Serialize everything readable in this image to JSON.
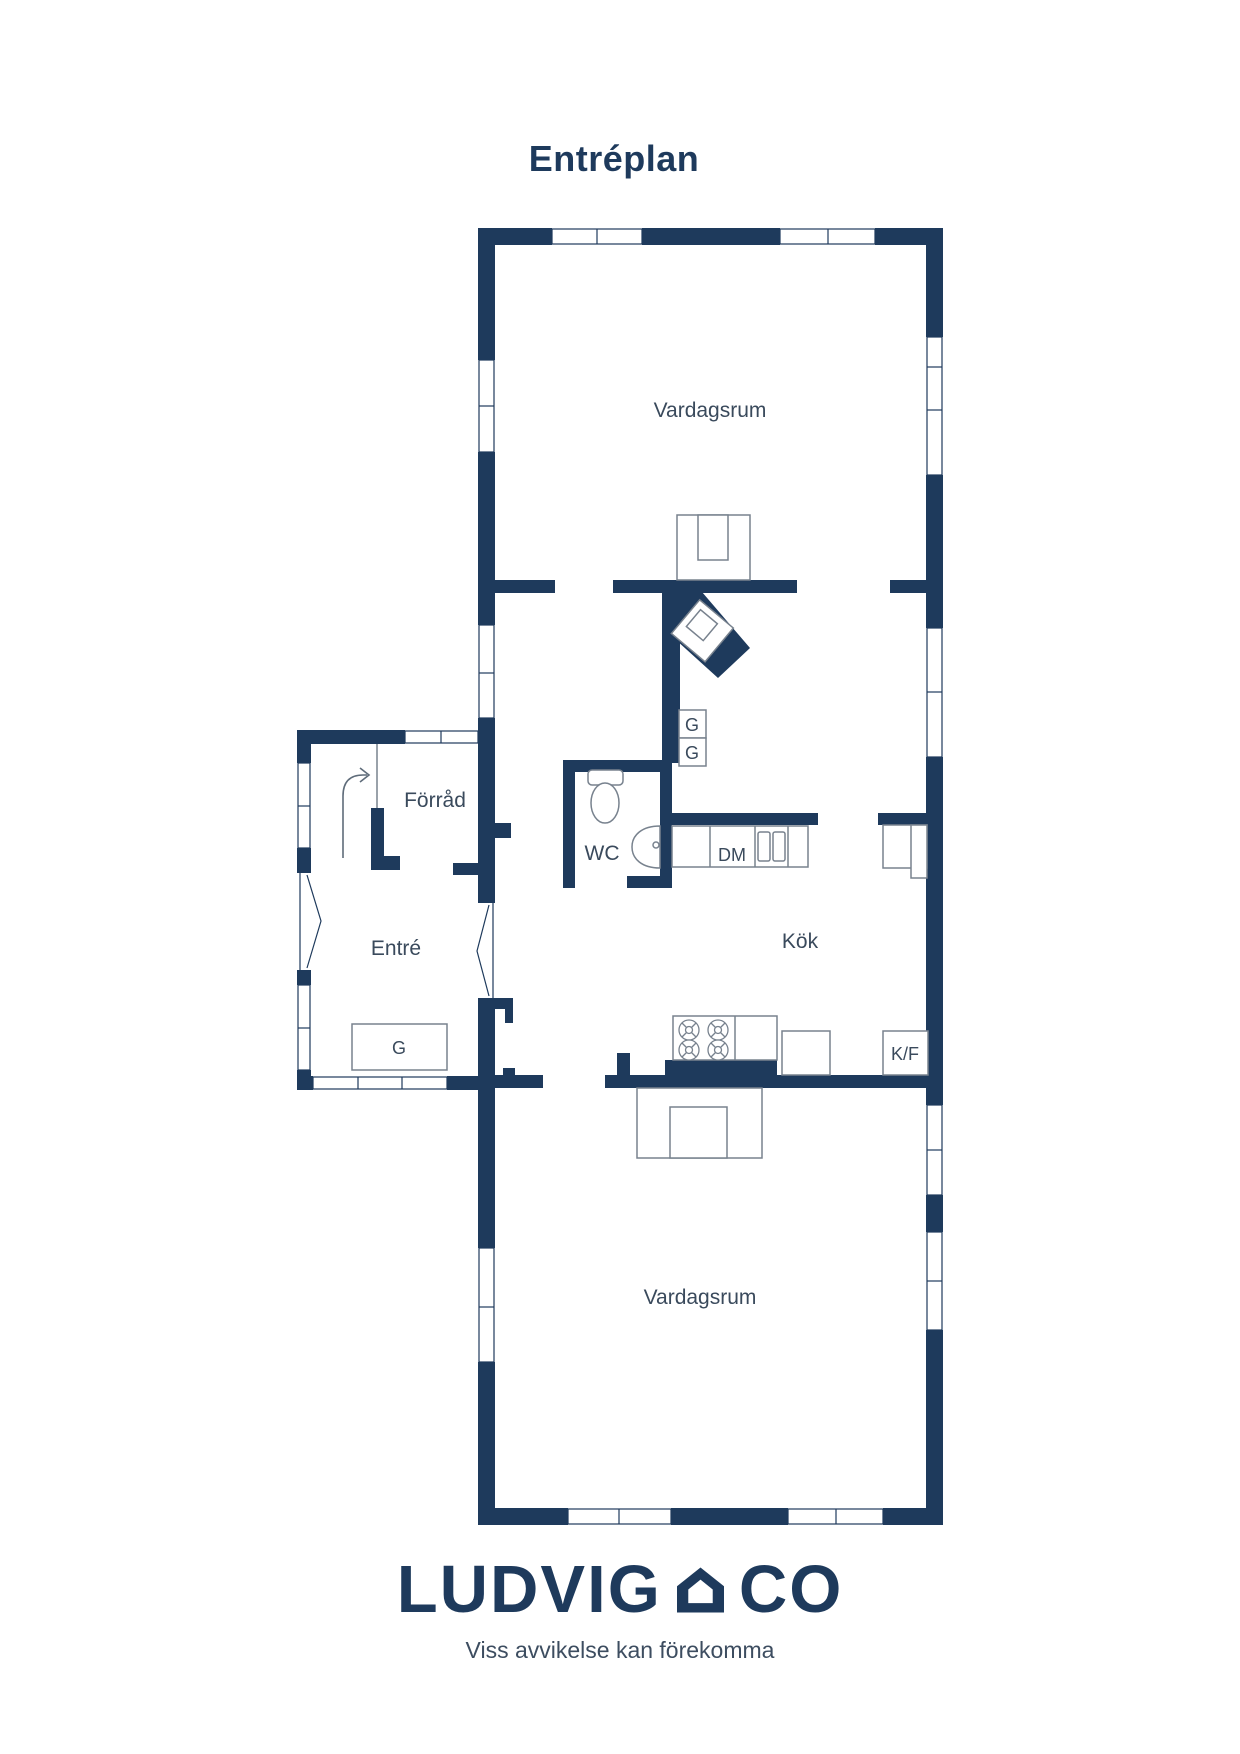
{
  "title": "Entréplan",
  "plan": {
    "rooms": {
      "vardagsrum_top": "Vardagsrum",
      "forrad": "Förråd",
      "entre": "Entré",
      "wc": "WC",
      "kok": "Kök",
      "vardagsrum_bottom": "Vardagsrum"
    },
    "fixtures": {
      "closet_top": "G",
      "closet_bottom": "G",
      "wardrobe_entre": "G",
      "dishwasher": "DM",
      "fridge_freezer": "K/F"
    }
  },
  "footer": {
    "brand_left": "LUDVIG",
    "brand_right": "CO",
    "disclaimer": "Viss avvikelse kan förekomma"
  },
  "colors": {
    "wall_navy": "#1e3a5c",
    "room_label": "#3a4a5c",
    "furniture_outline": "#78828e"
  }
}
